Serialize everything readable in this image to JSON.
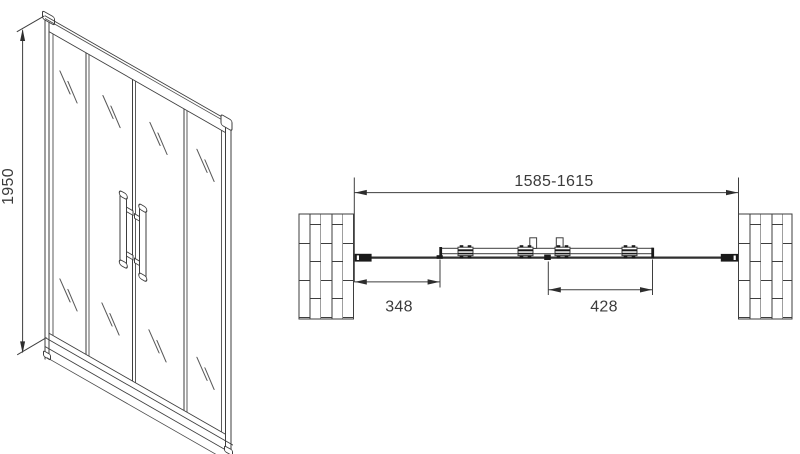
{
  "front_view": {
    "height_dimension": "1950"
  },
  "plan_view": {
    "overall_width_dimension": "1585-1615",
    "left_fixed_panel_dimension": "348",
    "sliding_door_dimension": "428"
  },
  "colors": {
    "line": "#3e3e3e",
    "text": "#3b3b3b",
    "solid_fill": "#1a1a1a",
    "background": "#ffffff"
  }
}
